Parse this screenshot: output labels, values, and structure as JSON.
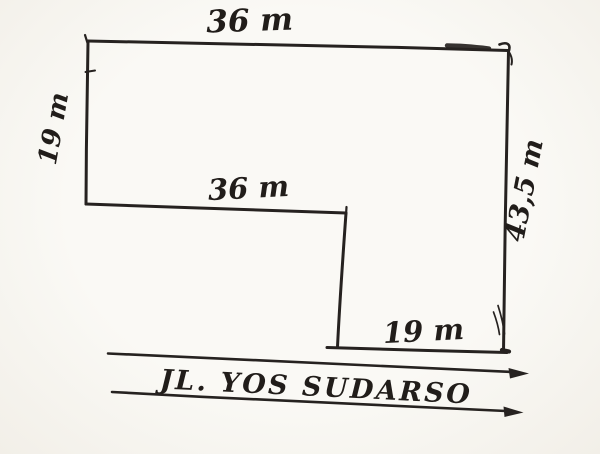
{
  "page": {
    "kind": "hand-drawn land plot sketch",
    "paper_color": "#f8f6f1",
    "ink_color": "#262220"
  },
  "plot_diagram": {
    "shape": "L-shaped plot outline",
    "measurements": [
      {
        "id": "top-width",
        "label": "36 m",
        "value_m": 36
      },
      {
        "id": "left-depth",
        "label": "19 m",
        "value_m": 19
      },
      {
        "id": "inner-width",
        "label": "36 m",
        "value_m": 36
      },
      {
        "id": "right-depth",
        "label": "43,5 m",
        "value_m": 43.5
      },
      {
        "id": "inner-bottom-width",
        "label": "19 m",
        "value_m": 19
      }
    ],
    "street": {
      "label": "JL. YOS SUDARSO",
      "arrow_direction": "right"
    }
  }
}
